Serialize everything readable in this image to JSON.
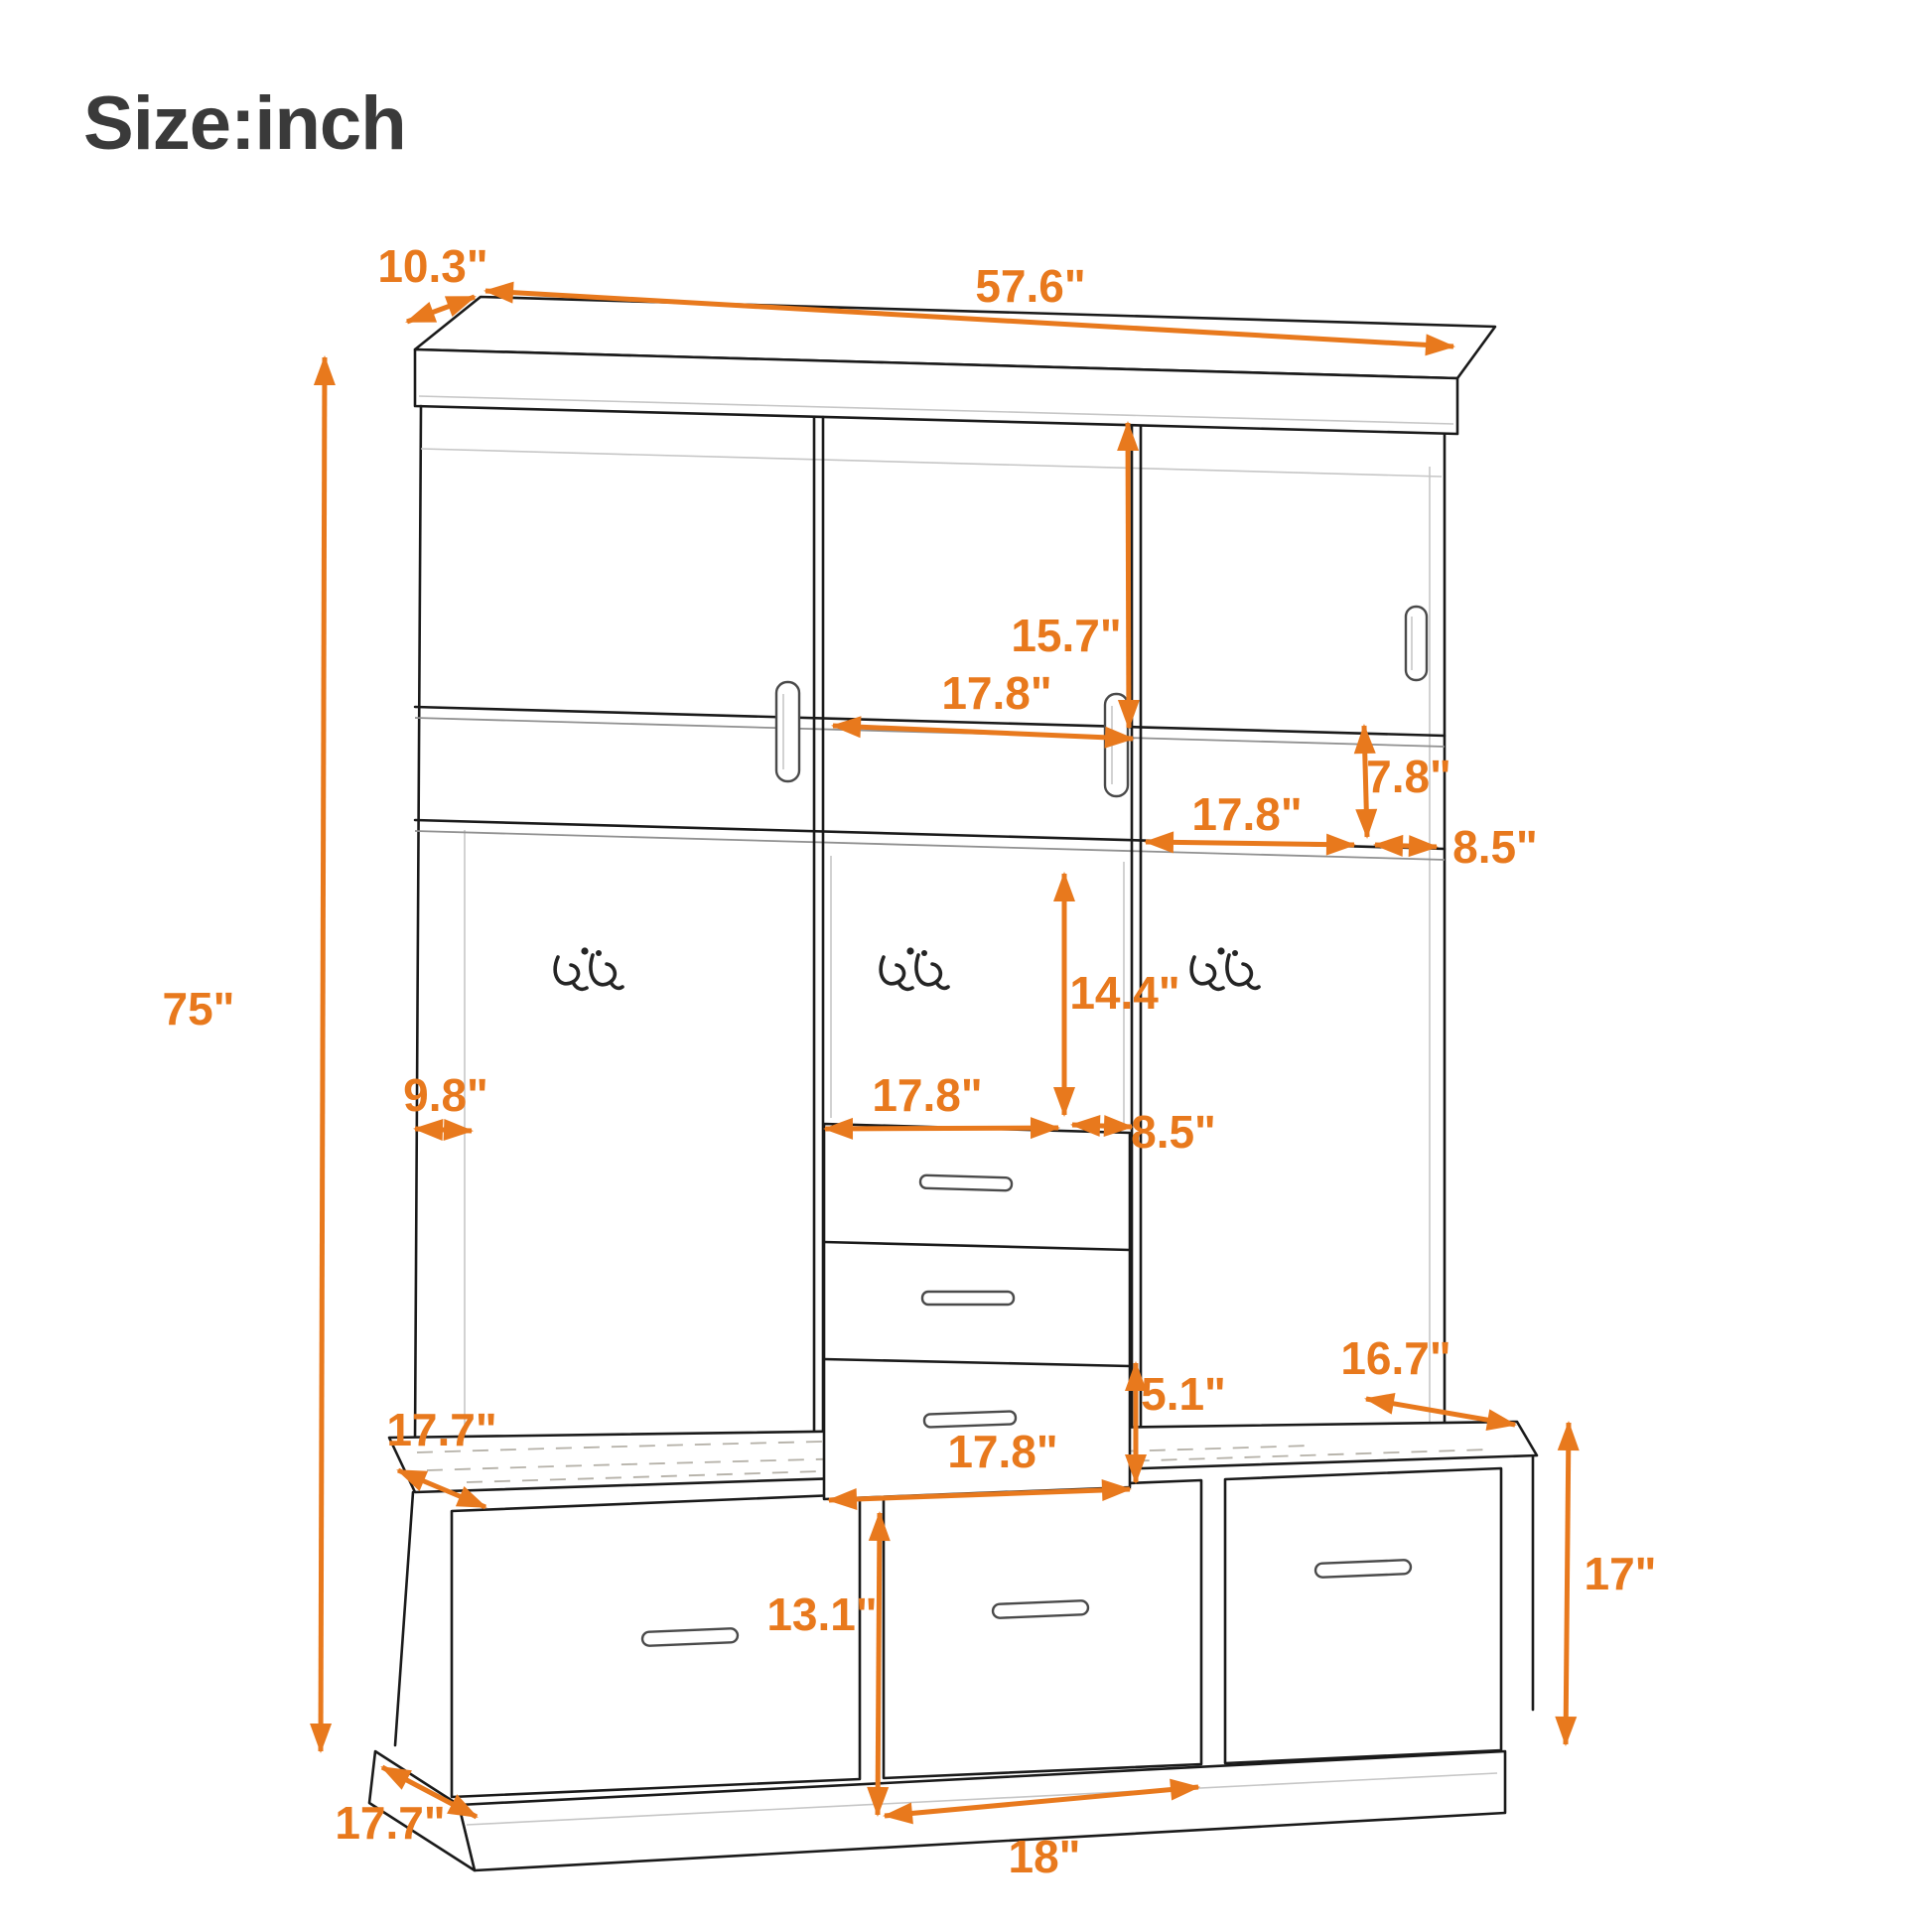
{
  "page": {
    "title": "Size:inch"
  },
  "colors": {
    "accent": "#E8791D",
    "line_ink": "#1A1A1A",
    "title_color": "#3A3A3A",
    "background": "#FFFFFF"
  },
  "dims": [
    {
      "id": "top-depth",
      "text": "10.3\""
    },
    {
      "id": "top-width",
      "text": "57.6\""
    },
    {
      "id": "upper-door-height",
      "text": "15.7\""
    },
    {
      "id": "upper-door-width",
      "text": "17.8\""
    },
    {
      "id": "cubby-height",
      "text": "7.8\""
    },
    {
      "id": "cubby-width",
      "text": "17.8\""
    },
    {
      "id": "right-cubby-width",
      "text": "8.5\""
    },
    {
      "id": "hook-area-height",
      "text": "14.4\""
    },
    {
      "id": "overall-height",
      "text": "75\""
    },
    {
      "id": "middle-width",
      "text": "17.8\""
    },
    {
      "id": "upper-depth",
      "text": "9.8\""
    },
    {
      "id": "side-width",
      "text": "8.5\""
    },
    {
      "id": "bench-top-depth",
      "text": "17.7\""
    },
    {
      "id": "small-drawer-height",
      "text": "5.1\""
    },
    {
      "id": "small-drawer-width",
      "text": "17.8\""
    },
    {
      "id": "bench-overhang-depth",
      "text": "16.7\""
    },
    {
      "id": "bench-height",
      "text": "17\""
    },
    {
      "id": "bench-drawer-height",
      "text": "13.1\""
    },
    {
      "id": "bench-drawer-width",
      "text": "18\""
    },
    {
      "id": "base-depth",
      "text": "17.7\""
    }
  ]
}
